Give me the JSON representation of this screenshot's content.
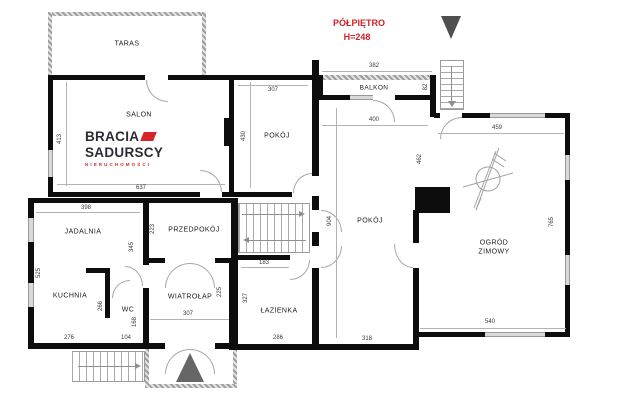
{
  "header": {
    "title": "PÓŁPIĘTRO",
    "height_note": "H=248"
  },
  "logo": {
    "line1": "BRACIA",
    "line2": "SADURSCY",
    "line3": "NIERUCHOMOŚCI"
  },
  "rooms": {
    "taras": "TARAS",
    "salon": "SALON",
    "pokoj_a": "POKÓJ",
    "balkon": "BALKON",
    "pokoj_b": "POKÓJ",
    "ogrod_zimowy": "OGRÓD ZIMOWY",
    "jadalnia": "JADALNIA",
    "kuchnia": "KUCHNIA",
    "wc": "WC",
    "przedpokoj": "PRZEDPOKÓJ",
    "wiatrolap": "WIATROŁAP",
    "lazienka": "ŁAZIENKA"
  },
  "dims": {
    "salon_w": "637",
    "salon_h": "413",
    "pokoj_a_w": "307",
    "pokoj_a_h": "430",
    "balkon_w": "382",
    "balkon_h": "82",
    "pokoj_b_w": "400",
    "pokoj_b_h_upper": "462",
    "pokoj_b_h": "904",
    "pokoj_b_h_lower": "296",
    "pokoj_b_w_bottom": "318",
    "ogrod_w": "459",
    "ogrod_h": "765",
    "ogrod_w_bottom": "540",
    "jadalnia_w": "398",
    "jadalnia_h": "525",
    "jadalnia_inner": "345",
    "przedpokoj_side": "223",
    "kuchnia_w": "276",
    "kuchnia_h": "266",
    "wc_w": "104",
    "wc_h": "168",
    "wiatrolap_w": "307",
    "wiatrolap_h": "225",
    "lazienka_w_top": "183",
    "lazienka_h": "327",
    "lazienka_w_bottom": "286"
  }
}
